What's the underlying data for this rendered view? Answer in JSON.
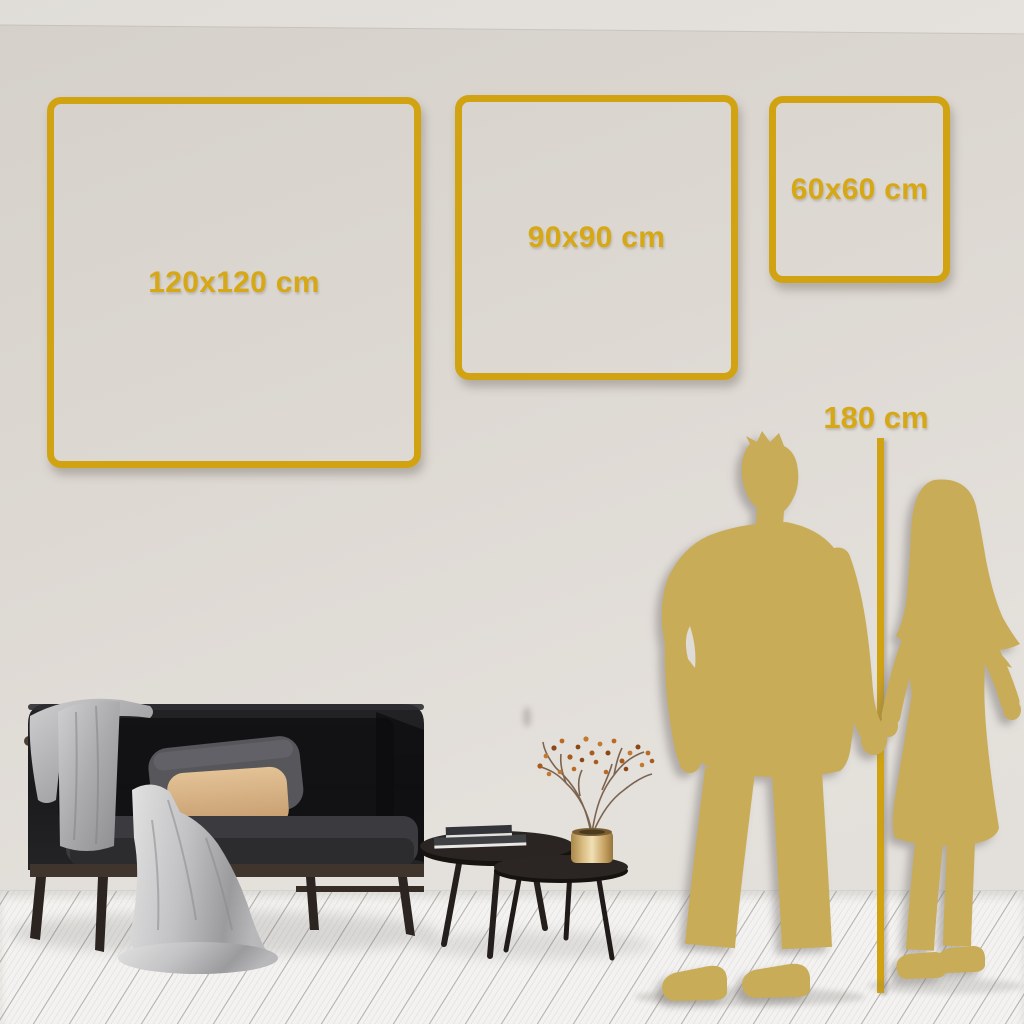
{
  "size_guide": {
    "frames": [
      {
        "label": "120x120 cm"
      },
      {
        "label": "90x90 cm"
      },
      {
        "label": "60x60 cm"
      }
    ],
    "height_marker": {
      "label": "180 cm"
    }
  },
  "colors": {
    "gold": "#D1A313",
    "gold_text": "#D7A815",
    "silhouette": "#C9AC57",
    "wall_dark": "#D5D0CA",
    "wall_mid": "#DDD8D2",
    "wall_light": "#E4E0DB",
    "floor": "#F3F2F0"
  },
  "scene_items": [
    "sofa",
    "throw-blanket",
    "gray-pillow",
    "tan-pillow",
    "nesting-coffee-tables",
    "books-stack",
    "brass-vase",
    "dried-branch",
    "couple-silhouette",
    "height-line"
  ]
}
